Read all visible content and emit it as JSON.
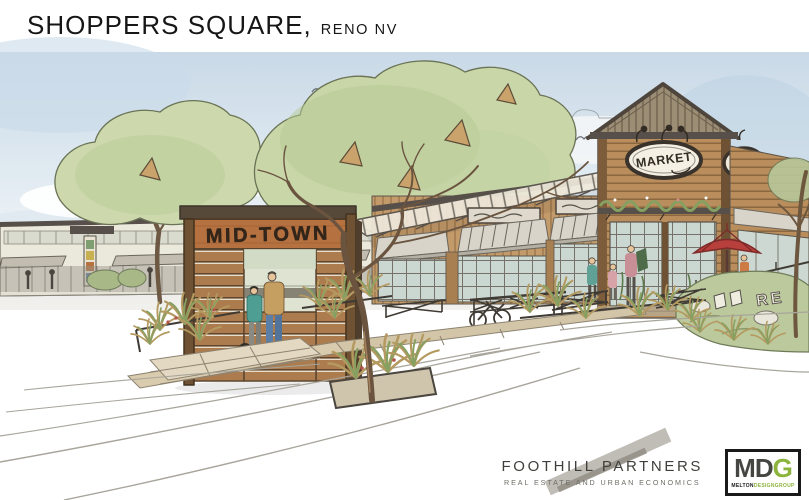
{
  "header": {
    "title": "SHOPPERS SQUARE,",
    "location": "RENO NV"
  },
  "illustration": {
    "alt": "Hand-drawn watercolor architectural rendering of the Shoppers Square retail center: a wooden MID-TOWN monument sign, a market hall with gabled tower and oval MARKET sign, shade canopies, trees, ornamental grasses, pedestrians and a red patio umbrella",
    "signs": {
      "monument": "MID-TOWN",
      "tower_oval": "MARKET",
      "landscape_letters": "RE"
    },
    "colors": {
      "sky_blue": "#cfdde9",
      "foliage_green": "#c9d6a8",
      "wood_tan": "#b98e5c",
      "sign_rust": "#b5713f",
      "umbrella_red": "#b8403c",
      "ink": "#4e463c",
      "glass_green": "#cbd8d1",
      "mural_purple": "#cfc6da"
    }
  },
  "footer": {
    "foothill": {
      "name": "FOOTHILL PARTNERS",
      "tagline": "REAL ESTATE AND URBAN ECONOMICS"
    },
    "mdg": {
      "md": "MD",
      "g": "G",
      "sub_left": "MELTON",
      "sub_right": "DESIGNGROUP",
      "accent_green": "#8cb43c"
    }
  }
}
